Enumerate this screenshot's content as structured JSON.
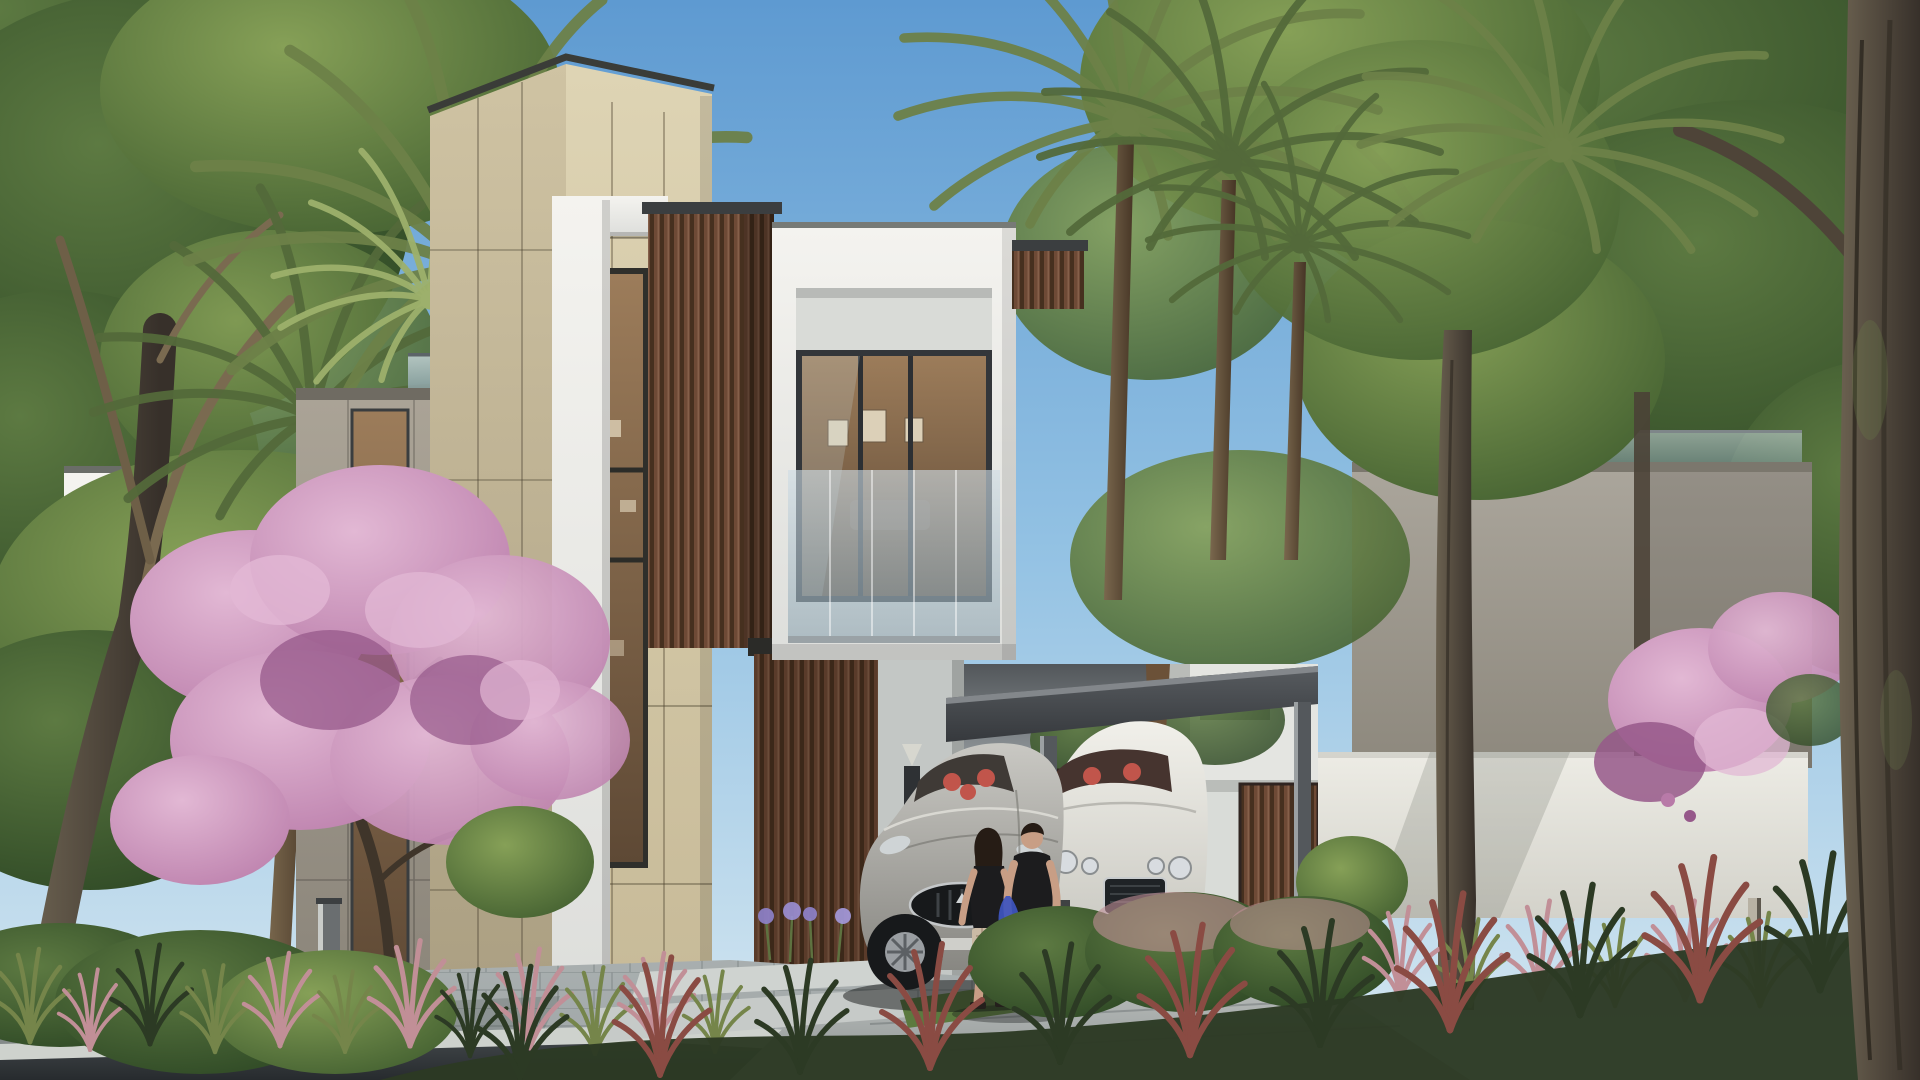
{
  "scene": {
    "description": "Daylight architectural rendering of a modern three-storey villa with beige stone tower, white cantilevered window box, dark wood slat screens, attached carport with two luxury coupes, a couple walking toward the entrance, palm trees, a pink flowering tree and landscaped street-front garden",
    "main_villa": {
      "materials": [
        "beige stone panels",
        "white plaster",
        "dark wood vertical slats",
        "bronze-tinted glazing"
      ],
      "features": [
        "stone tower with narrow window strip",
        "cantilevered white window box with glass balustrade",
        "carport canopy on slim posts",
        "wood entrance door with wall sconce"
      ]
    },
    "vehicles": [
      {
        "name": "silver sports coupe",
        "body_color": "silver",
        "interior_color": "red",
        "grille": "oval chrome with vertical bars"
      },
      {
        "name": "white luxury coupe",
        "body_color": "white",
        "interior_color": "red",
        "headlights": "four round"
      }
    ],
    "people": [
      {
        "name": "woman",
        "hair": "long dark",
        "top": "black sleeveless",
        "bottom": "beige plaid shorts",
        "shoes": "black sandals"
      },
      {
        "name": "man",
        "hair": "short dark",
        "top": "black t-shirt",
        "bottom": "red shorts",
        "shoes": "white sneakers",
        "carrying": "blue bag"
      }
    ],
    "vegetation": [
      "palm trees",
      "leafy canopy trees",
      "pink flowering tree",
      "bougainvillea on garden wall",
      "ornamental grasses with pink plumes",
      "agapanthus flowers",
      "round clipped shrubs"
    ],
    "street": [
      "paved sidewalk",
      "light curb",
      "asphalt road",
      "concrete driveway",
      "square bollard lights"
    ]
  },
  "palette": {
    "sky_top": "#5e9ad1",
    "sky_mid": "#92c1e3",
    "sky_low": "#d7e8f1",
    "beige_hi": "#ded4b4",
    "beige_lo": "#c7ba98",
    "beige_side_hi": "#cfc3a3",
    "beige_side_lo": "#ab9f82",
    "wing_hi": "#aaa396",
    "wing_lo": "#8b857a",
    "white_hi": "#f4f3ef",
    "white_lo": "#dddedb",
    "wood_mid": "#6e4a36",
    "wood_dark": "#46301f",
    "wood_lite": "#85604a",
    "fascia_hi": "#585c60",
    "fascia_lo": "#36393d",
    "glass_hi": "#cfdde6",
    "glass_lo": "#8fa6b2",
    "interior_hi": "#9c7c5a",
    "interior_lo": "#5e4935",
    "canopy_hi": "#86a057",
    "canopy_lo": "#3f5c2e",
    "canopyd_hi": "#5d7a42",
    "canopyd_lo": "#2b4523",
    "palm_green": "#6d8148",
    "palm_dark": "#53693a",
    "palm_lite": "#9db06c",
    "palmtrunk_hi": "#7a684e",
    "palmtrunk_lo": "#463525",
    "trunk_hi": "#6b6150",
    "trunk_lo": "#37302a",
    "pink_hi": "#e2b8d4",
    "pink_lo": "#b87aa8",
    "pink_deep": "#96588a",
    "nvilla_hi": "#aaa59b",
    "nvilla_lo": "#8d887d",
    "wallr_hi": "#edece5",
    "wallr_lo": "#d3d2ca",
    "drive_hi": "#b6bab8",
    "drive_lo": "#8f9595",
    "paver_hi": "#a4abac",
    "paver_lo": "#848b8d",
    "curb": "#ced2cd",
    "road_hi": "#3e4346",
    "road_lo": "#272b2e",
    "silver_hi": "#c9c8c3",
    "silver_lo": "#888782",
    "whitecar_hi": "#f1f0ea",
    "whitecar_lo": "#c5c4bd",
    "seat_red": "#c1554b",
    "tire": "#17191b",
    "skin": "#c89e85",
    "hair_dark": "#261c15",
    "black_cloth": "#1c1c1e",
    "shorts_red": "#a04a42",
    "shorts_plaid": "#cbbaa5",
    "bag_blue": "#3e55c0",
    "shoe_white": "#e9e7e1",
    "grass_green": "#75854a",
    "grass_pink": "#c18f97",
    "grass_dark": "#2c3a24",
    "grass_red": "#8a4b43",
    "joint": "#6f6450"
  }
}
